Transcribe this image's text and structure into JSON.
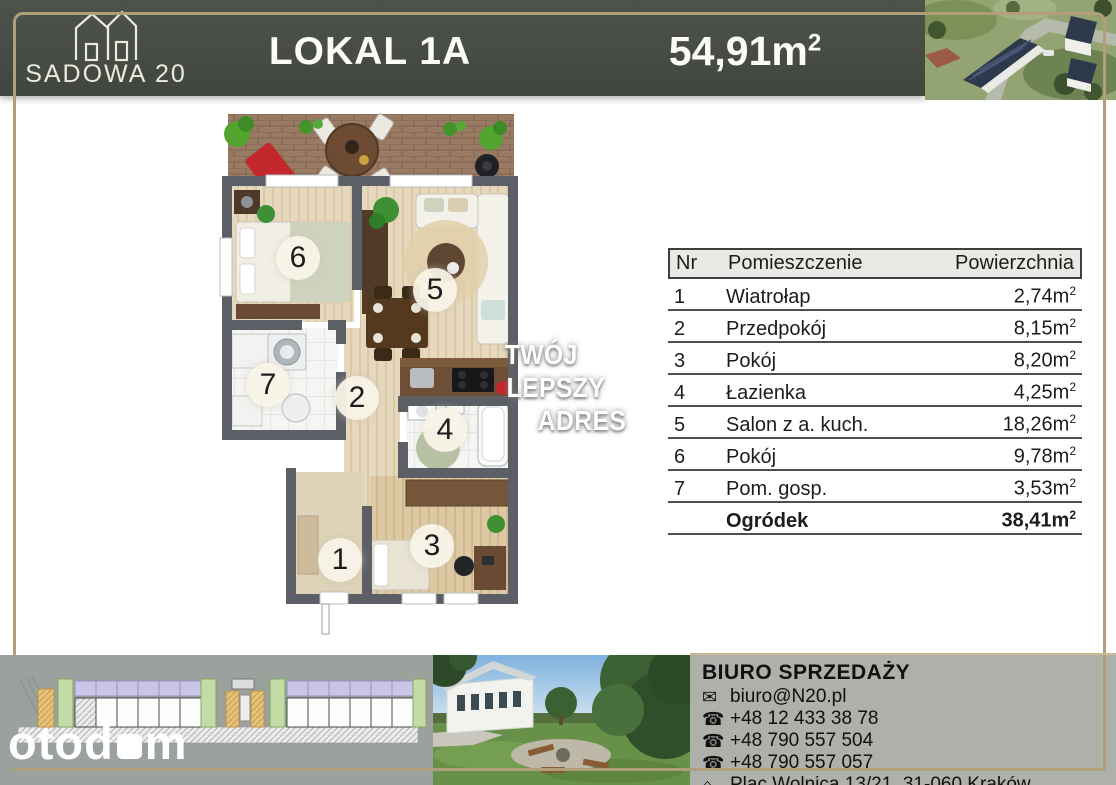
{
  "header": {
    "logo_name": "SADOWA 20",
    "unit_label": "LOKAL 1A",
    "area_value": "54,91m",
    "area_sup": "2"
  },
  "watermark": {
    "line1": "TWÓJ",
    "line2": "LEPSZY",
    "line3": "ADRES"
  },
  "plan": {
    "numbers": [
      "1",
      "2",
      "3",
      "4",
      "5",
      "6",
      "7"
    ]
  },
  "table": {
    "headers": {
      "nr": "Nr",
      "room": "Pomieszczenie",
      "area": "Powierzchnia"
    },
    "unit_sup": "2",
    "rows": [
      {
        "nr": "1",
        "room": "Wiatrołap",
        "area": "2,74m"
      },
      {
        "nr": "2",
        "room": "Przedpokój",
        "area": "8,15m"
      },
      {
        "nr": "3",
        "room": "Pokój",
        "area": "8,20m"
      },
      {
        "nr": "4",
        "room": "Łazienka",
        "area": "4,25m"
      },
      {
        "nr": "5",
        "room": "Salon z a. kuch.",
        "area": "18,26m"
      },
      {
        "nr": "6",
        "room": "Pokój",
        "area": "9,78m"
      },
      {
        "nr": "7",
        "room": "Pom. gosp.",
        "area": "3,53m"
      },
      {
        "nr": "",
        "room": "Ogródek",
        "area": "38,41m"
      }
    ]
  },
  "footer": {
    "brand_left": "otod",
    "brand_right": "m",
    "office": {
      "title": "BIURO SPRZEDAŻY",
      "email": "biuro@N20.pl",
      "phones": [
        "+48 12 433 38 78",
        "+48 790 557 504",
        "+48 790 557 057"
      ],
      "address": "Plac Wolnica 13/21, 31-060 Kraków",
      "icons": {
        "email": "✉",
        "phone": "☎",
        "address": "⌂"
      }
    }
  },
  "colors": {
    "gold": "#b19f7c",
    "header_bg": "#474c44",
    "panel_gray": "#9ba19c",
    "contact_bg": "#adb1aa"
  }
}
